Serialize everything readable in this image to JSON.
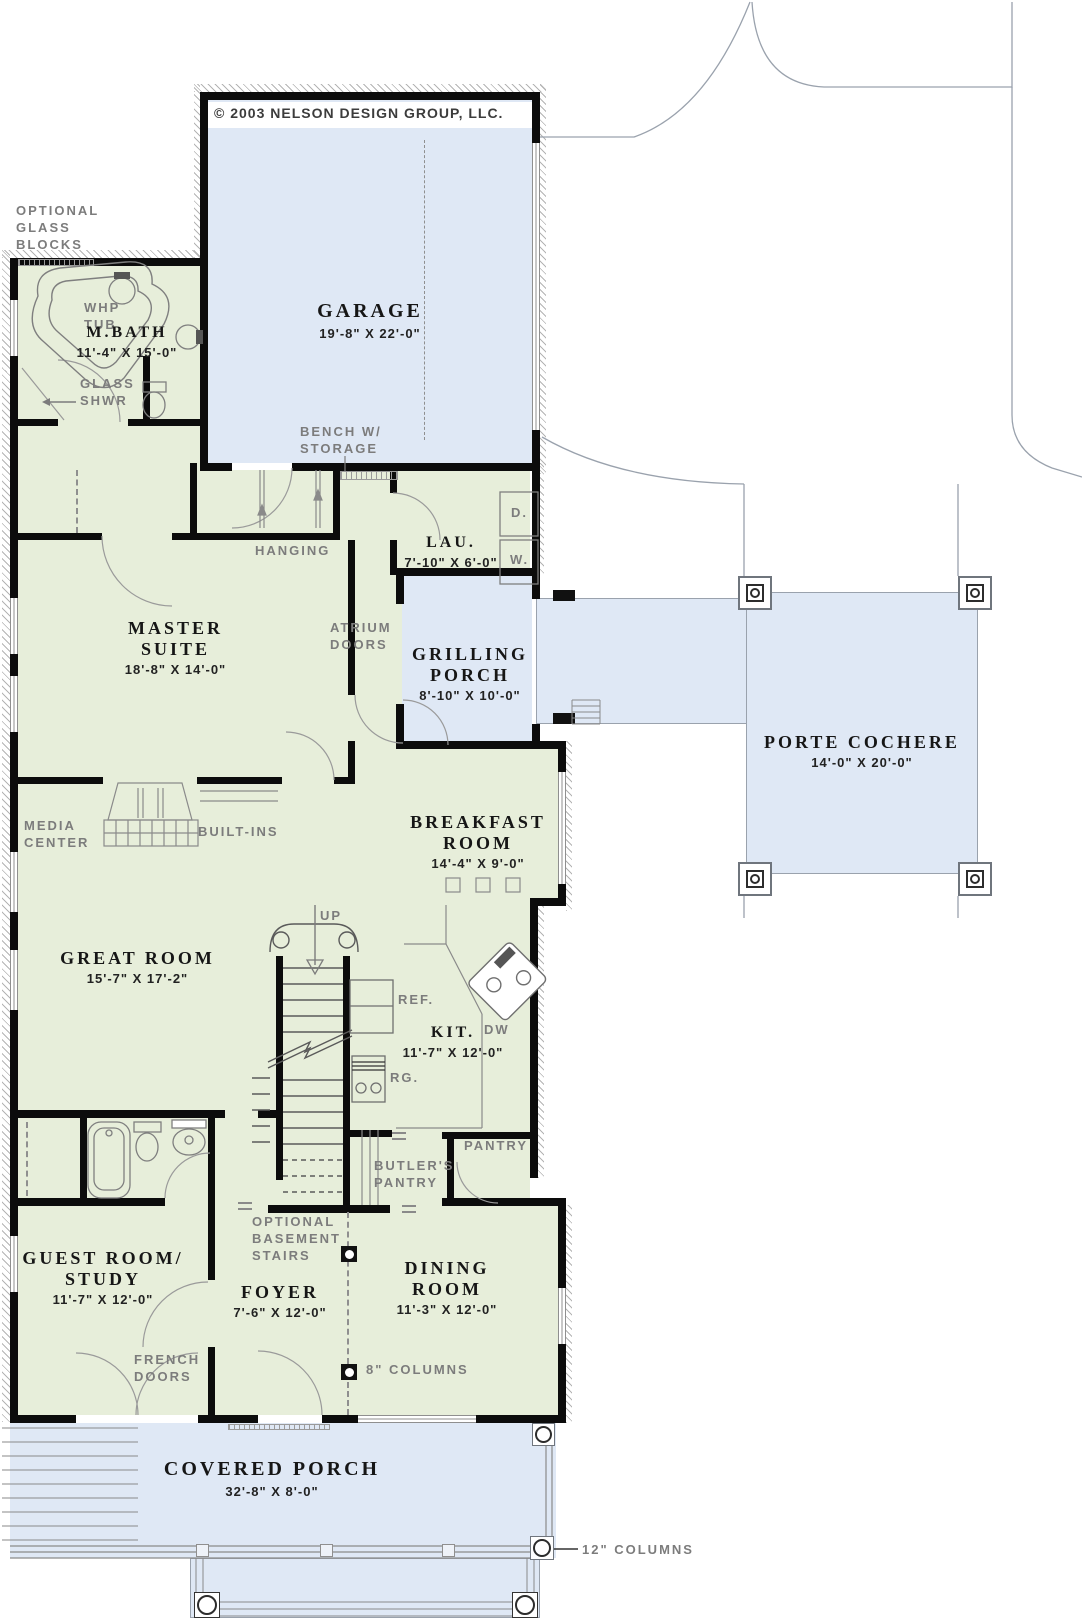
{
  "copyright": "© 2003 NELSON DESIGN GROUP, LLC.",
  "colors": {
    "interior": "#e7eeda",
    "outdoor": "#dfe8f5",
    "wall": "#0c0c0c",
    "annotation": "#7c7c7c",
    "linework": "#8a8a8a"
  },
  "rooms": {
    "garage": {
      "name": "GARAGE",
      "dims": "19'-8\" X 22'-0\""
    },
    "mbath": {
      "name": "M.BATH",
      "dims": "11'-4\" X 15'-0\""
    },
    "laundry": {
      "name": "LAU.",
      "dims": "7'-10\" X 6'-0\""
    },
    "master": {
      "name": "MASTER SUITE",
      "dims": "18'-8\" X 14'-0\""
    },
    "grilling": {
      "name": "GRILLING PORCH",
      "dims": "8'-10\" X 10'-0\""
    },
    "porte": {
      "name": "PORTE COCHERE",
      "dims": "14'-0\" X 20'-0\""
    },
    "breakfast": {
      "name": "BREAKFAST ROOM",
      "dims": "14'-4\" X 9'-0\""
    },
    "great": {
      "name": "GREAT ROOM",
      "dims": "15'-7\" X 17'-2\""
    },
    "kitchen": {
      "name": "KIT.",
      "dims": "11'-7\" X 12'-0\""
    },
    "guest": {
      "name": "GUEST ROOM/ STUDY",
      "dims": "11'-7\" X 12'-0\""
    },
    "foyer": {
      "name": "FOYER",
      "dims": "7'-6\" X 12'-0\""
    },
    "dining": {
      "name": "DINING ROOM",
      "dims": "11'-3\" X 12'-0\""
    },
    "porch": {
      "name": "COVERED PORCH",
      "dims": "32'-8\" X 8'-0\""
    }
  },
  "annotations": {
    "optional_glass_blocks": "OPTIONAL GLASS BLOCKS",
    "whp_tub": "WHP TUB",
    "glass_shwr": "GLASS SHWR",
    "hanging": "HANGING",
    "bench": "BENCH W/ STORAGE",
    "atrium_doors": "ATRIUM DOORS",
    "media_center": "MEDIA CENTER",
    "built_ins": "BUILT-INS",
    "up": "UP",
    "ref": "REF.",
    "dw": "DW",
    "rg": "RG.",
    "dryer": "D.",
    "washer": "W.",
    "pantry": "PANTRY",
    "butlers_pantry": "BUTLER'S PANTRY",
    "opt_basement": "OPTIONAL BASEMENT STAIRS",
    "french_doors": "FRENCH DOORS",
    "columns8": "8\" COLUMNS",
    "columns12": "12\" COLUMNS"
  }
}
